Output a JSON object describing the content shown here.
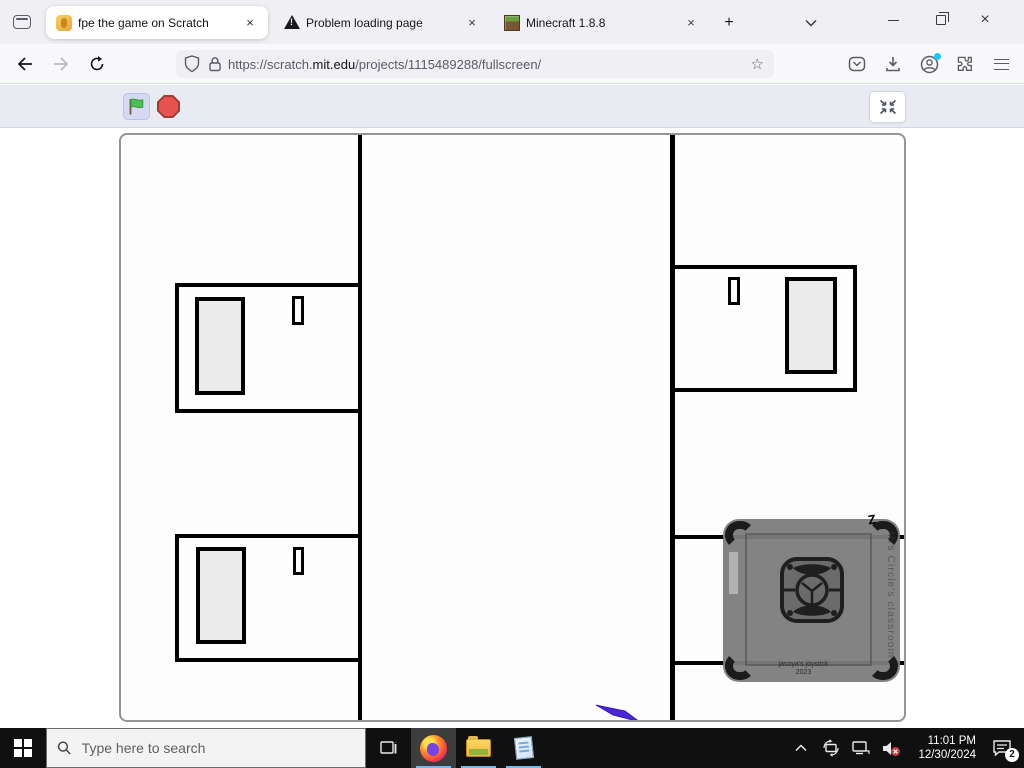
{
  "glyphs": {
    "close": "×",
    "new_tab": "+",
    "star": "☆"
  },
  "browser": {
    "tabs": [
      {
        "title": "fpe the game on Scratch",
        "icon": "scratch-favicon"
      },
      {
        "title": "Problem loading page",
        "icon": "warning-icon"
      },
      {
        "title": "Minecraft 1.8.8",
        "icon": "minecraft-favicon"
      }
    ],
    "url": {
      "prefix": "https://scratch.",
      "domain": "mit.edu",
      "path": "/projects/1115489288/fullscreen/"
    }
  },
  "joystick": {
    "label_line1": "jasoya's joystick",
    "label_line2": "2023",
    "side_label": "Mrs Circle's classroom",
    "corner_letter": "Z"
  },
  "taskbar": {
    "search_placeholder": "Type here to search",
    "time": "11:01 PM",
    "date": "12/30/2024",
    "notification_count": "2"
  },
  "colors": {
    "flag_green": "#4cbf56",
    "stop_red": "#e8534f",
    "taskbar_underline": "#76b9ed",
    "account_dot": "#19c8ff",
    "pen_blue": "#4a26d9"
  }
}
